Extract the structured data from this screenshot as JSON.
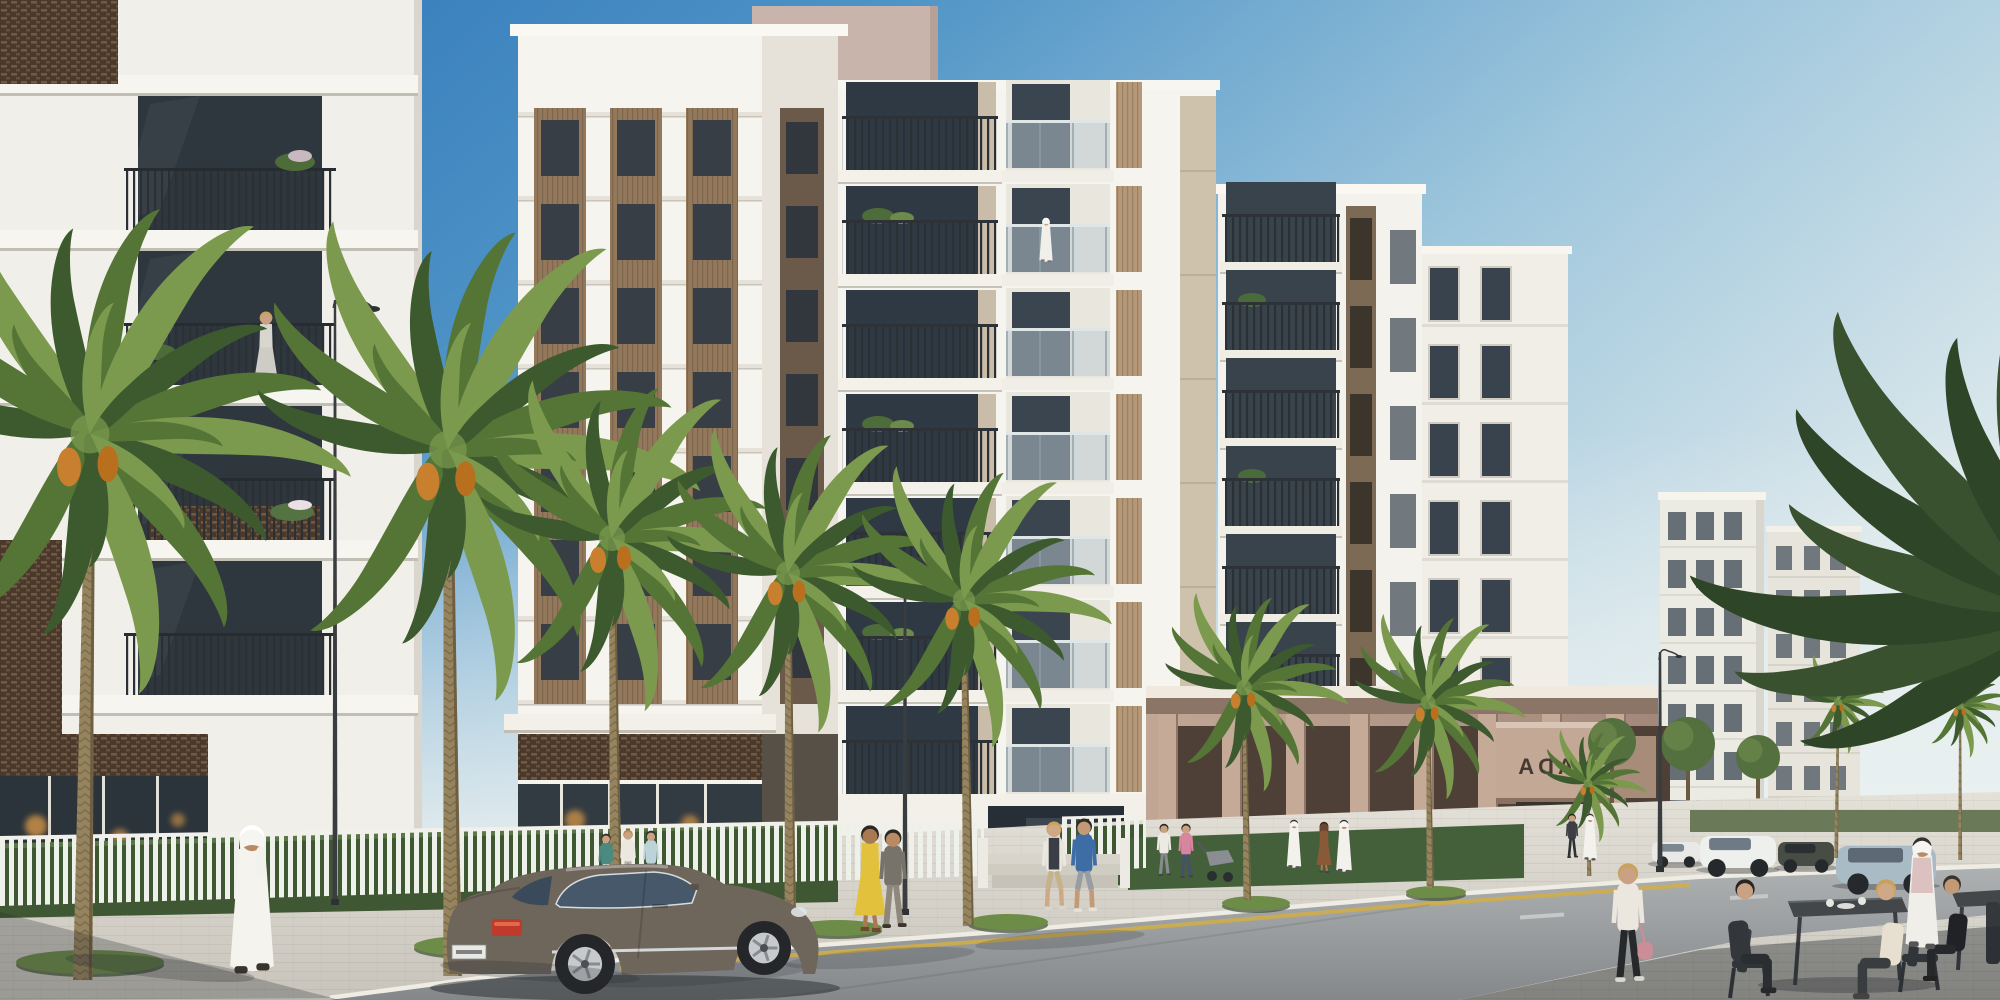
{
  "scene": {
    "description": "Sunlit architectural rendering of a modern white residential community along a palm-lined street, with pedestrians, a parked grey luxury coupe and an outdoor cafe terrace in the foreground",
    "sign": {
      "text": "NADA",
      "mirrored": true
    },
    "license_plate": {
      "legible": false
    },
    "elements": [
      {
        "name": "sky",
        "label": "clear gradient blue sky"
      },
      {
        "name": "left-building",
        "label": "foreground white apartment building with dark lattice panels and planted balconies"
      },
      {
        "name": "louvre-tower",
        "label": "white tower with bronze louvred window strips"
      },
      {
        "name": "balcony-tower",
        "label": "white tower with stacked open balconies"
      },
      {
        "name": "right-tower",
        "label": "white tower with bronze accent strip"
      },
      {
        "name": "podium",
        "label": "taupe retail podium with colonnade and mirrored NADA canopy sign"
      },
      {
        "name": "far-buildings",
        "label": "distant white residential blocks"
      },
      {
        "name": "palm-trees",
        "label": "date palms with orange fruit clusters lining the sidewalk"
      },
      {
        "name": "street-fence",
        "label": "white vertical-slat fence with hedge"
      },
      {
        "name": "street-lamps",
        "label": "dark curved street lamps"
      },
      {
        "name": "luxury-coupe",
        "label": "grey luxury coupe parked at the curb"
      },
      {
        "name": "background-cars",
        "label": "parked cars on the far side of the street"
      },
      {
        "name": "cafe-terrace",
        "label": "outdoor cafe tables and chairs with seated guests"
      },
      {
        "name": "pedestrians",
        "label": "residents walking along the sidewalk, several in white kanduras"
      }
    ]
  },
  "palette": {
    "skyTop": "#2b72b6",
    "skyMid": "#4e93c6",
    "skyLow": "#9ec6dc",
    "skyHorizon": "#dde9ec",
    "facadeSun": "#f6f4ee",
    "facadeShade": "#e6e2da",
    "slab": "#e3dfd6",
    "bronze": "#93785c",
    "bronzeDark": "#383e45",
    "latticeDark": "#4a392b",
    "latticeDot": "#caa87a",
    "mauve": "#c8b4ab",
    "podiumTaupe": "#b79a8a",
    "canopyFace": "#c3a896",
    "signDark": "#463a30",
    "glassDark": "#2e363e",
    "glassBlue": "#46586a",
    "railDark": "#2b3035",
    "glassRail": "#b9c9cf",
    "hedge": "#3f5733",
    "palmDark": "#3c5a2e",
    "palmMid": "#547536",
    "palmLight": "#7c9a4e",
    "trunk": "#96845e",
    "dates": "#c87f2e",
    "sidewalk": "#d6d2c9",
    "road": "#97999c",
    "roadFar": "#aeb1b2",
    "curb": "#efece4",
    "yellowLine": "#d2ae45",
    "carBody": "#6e655b",
    "carGlass": "#46586a",
    "tailLight": "#bf3a2b",
    "plate": "#e8e9e4",
    "lamp": "#3a3d3f",
    "terrace": "#cfccc3",
    "shadow": "#23282c"
  },
  "figures": [
    {
      "id": "balcony-woman",
      "label": "woman on balcony",
      "layer": "balcony",
      "kind": "dress",
      "x": 266,
      "y": 386,
      "h": 74,
      "skin": "#c9a184",
      "hair": "#caa25e",
      "top": "#d9d5cf",
      "bottom": "#cfccc6",
      "shoes": "#555555",
      "vest": "#3c4248"
    },
    {
      "id": "balcony-resident",
      "label": "resident on tower balcony",
      "layer": "balcony",
      "kind": "robe",
      "x": 1046,
      "y": 262,
      "h": 44,
      "skin": "#c9a184",
      "hair": "#ffffff",
      "top": "#f0efe9",
      "shoes": "#777777",
      "ghutra": true
    },
    {
      "id": "kandura-man",
      "label": "man in white kandura",
      "layer": "main",
      "kind": "robe",
      "x": 252,
      "y": 972,
      "h": 146,
      "skin": "#b98a63",
      "hair": "#ffffff",
      "top": "#f4f3ee",
      "shoes": "#3a332c",
      "ghutra": true,
      "flip": true
    },
    {
      "id": "woman-teal",
      "label": "woman in teal top",
      "layer": "main",
      "kind": "walk",
      "x": 606,
      "y": 888,
      "h": 54,
      "top": "#4a8a80",
      "bottom": "#e6e3db",
      "skin": "#caa183",
      "hair": "#2e2a26",
      "shoes": "#444444"
    },
    {
      "id": "woman-white",
      "label": "woman in white top",
      "layer": "main",
      "kind": "walk",
      "x": 628,
      "y": 886,
      "h": 56,
      "top": "#ebe8e0",
      "bottom": "#b9b2a6",
      "skin": "#c9a183",
      "hair": "#b9884e",
      "shoes": "#444444"
    },
    {
      "id": "woman-lightblue",
      "label": "woman in light blue top",
      "layer": "main",
      "kind": "walk",
      "x": 651,
      "y": 888,
      "h": 57,
      "top": "#bcd3da",
      "bottom": "#98a1a6",
      "skin": "#caa183",
      "hair": "#35302a",
      "shoes": "#444444"
    },
    {
      "id": "woman-yellow",
      "label": "woman in yellow dress",
      "layer": "main",
      "kind": "dress",
      "x": 870,
      "y": 930,
      "h": 104,
      "top": "#e2c13c",
      "bottom": "#e2c13c",
      "skin": "#a97a52",
      "hair": "#2c2722",
      "shoes": "#6b4a2e"
    },
    {
      "id": "companion",
      "label": "companion",
      "layer": "main",
      "kind": "walk",
      "x": 893,
      "y": 928,
      "h": 98,
      "top": "#77736a",
      "bottom": "#8d887b",
      "skin": "#b98a63",
      "hair": "#2c2722",
      "shoes": "#3a352e"
    },
    {
      "id": "couple-woman",
      "label": "walking woman with vest",
      "layer": "main",
      "kind": "walk",
      "x": 1054,
      "y": 910,
      "h": 88,
      "top": "#eae7e0",
      "bottom": "#c6b28a",
      "skin": "#cfa985",
      "hair": "#c9a25c",
      "shoes": "#d8d5cd",
      "vest": "#3a3f45",
      "shorts": true
    },
    {
      "id": "couple-man",
      "label": "walking man in blue polo",
      "layer": "main",
      "kind": "walk",
      "x": 1084,
      "y": 912,
      "h": 93,
      "top": "#3e6da6",
      "bottom": "#979da2",
      "skin": "#c29a76",
      "hair": "#2e2a25",
      "shoes": "#e3e1da",
      "shorts": true
    },
    {
      "id": "father-stroller",
      "label": "man with stroller",
      "layer": "main",
      "kind": "walk",
      "x": 1164,
      "y": 876,
      "h": 52,
      "top": "#eceae3",
      "bottom": "#878b90",
      "skin": "#c9a183",
      "hair": "#2c2621",
      "shoes": "#444444"
    },
    {
      "id": "mother-pink",
      "label": "woman in pink top",
      "layer": "main",
      "kind": "walk",
      "x": 1186,
      "y": 878,
      "h": 54,
      "top": "#d886a0",
      "bottom": "#46506b",
      "skin": "#caa183",
      "hair": "#2e2a26",
      "shoes": "#444444"
    },
    {
      "id": "woman-rust",
      "label": "woman in rust abaya",
      "layer": "main",
      "kind": "dress",
      "x": 1324,
      "y": 872,
      "h": 50,
      "top": "#8a5a38",
      "bottom": "#8a5a38",
      "skin": "#a97a52",
      "hair": "#2a2520",
      "shoes": "#444444",
      "scarf": "#6b4530"
    },
    {
      "id": "thobe-man-1",
      "label": "man in white thobe",
      "layer": "main",
      "kind": "robe",
      "x": 1344,
      "y": 872,
      "h": 52,
      "top": "#f2f1ec",
      "skin": "#b98a63",
      "ghutra": true,
      "shoes": "#555555"
    },
    {
      "id": "thobe-man-2",
      "label": "man in white thobe",
      "layer": "main",
      "kind": "robe",
      "x": 1294,
      "y": 868,
      "h": 48,
      "top": "#f2f1ec",
      "skin": "#b98a63",
      "ghutra": true,
      "shoes": "#555555"
    },
    {
      "id": "visitor-dark",
      "label": "visitor in dark clothes",
      "layer": "main",
      "kind": "walk",
      "x": 1572,
      "y": 858,
      "h": 44,
      "top": "#3c3f44",
      "bottom": "#2e3134",
      "skin": "#caa183",
      "hair": "#26211d",
      "shoes": "#333333"
    },
    {
      "id": "thobe-man-3",
      "label": "man in white thobe",
      "layer": "main",
      "kind": "robe",
      "x": 1590,
      "y": 860,
      "h": 46,
      "top": "#f2f1ec",
      "skin": "#b98a63",
      "ghutra": true,
      "shoes": "#555555"
    },
    {
      "id": "cafe-walking-woman",
      "label": "woman walking with pink bag",
      "layer": "cafe",
      "kind": "walk",
      "x": 1628,
      "y": 982,
      "h": 118,
      "top": "#ebe7de",
      "bottom": "#26282b",
      "skin": "#c9a183",
      "hair": "#c9a25c",
      "shoes": "#d9d6cf",
      "bag": "#cb8d97"
    },
    {
      "id": "cafe-seated-man",
      "label": "seated man in dark shirt",
      "layer": "cafe",
      "kind": "seated",
      "x": 1745,
      "y": 992,
      "h": 112,
      "top": "#33373b",
      "bottom": "#2b2e31",
      "skin": "#c9a183",
      "hair": "#2b2521",
      "shoes": "#26282a"
    },
    {
      "id": "cafe-blonde-woman",
      "label": "seated blonde woman",
      "layer": "cafe",
      "kind": "seated",
      "x": 1886,
      "y": 998,
      "h": 118,
      "top": "#e7dfd0",
      "bottom": "#3a3d40",
      "skin": "#cfa985",
      "hair": "#c9a05c",
      "shoes": "#444444",
      "flip": true
    },
    {
      "id": "cafe-man-black",
      "label": "seated man in black",
      "layer": "cafe",
      "kind": "seated",
      "x": 1952,
      "y": 980,
      "h": 104,
      "top": "#202225",
      "bottom": "#26282b",
      "skin": "#c29a76",
      "hair": "#3a332c",
      "shoes": "#222222",
      "flip": true
    },
    {
      "id": "cafe-standing-man",
      "label": "standing man in white ghutra",
      "layer": "cafe",
      "kind": "robe",
      "x": 1922,
      "y": 948,
      "h": 110,
      "top": "#efeee9",
      "skin": "#b98a63",
      "ghutra": true,
      "shoes": "#555555",
      "shawl": "#d8b8ba"
    }
  ]
}
